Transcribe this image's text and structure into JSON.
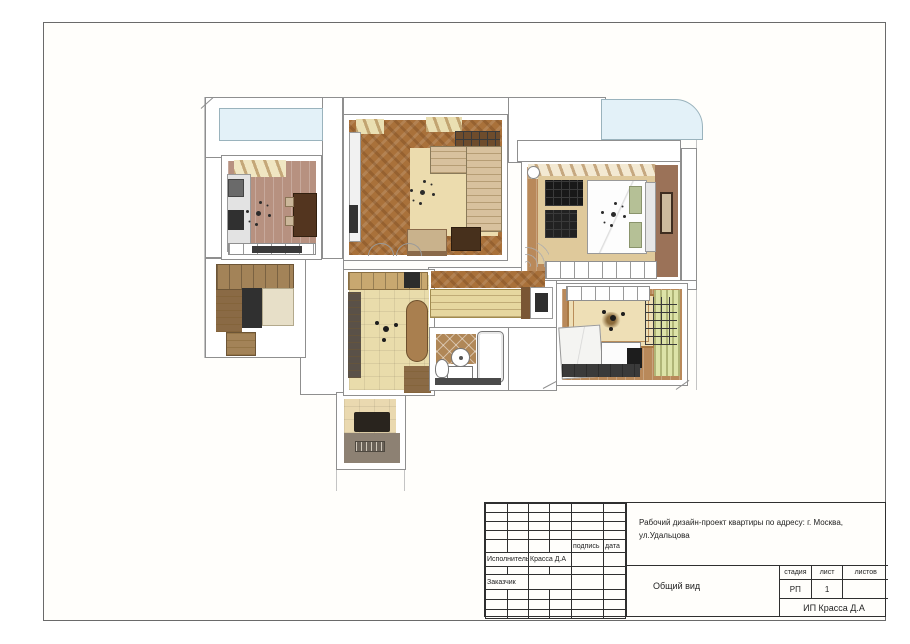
{
  "title_block": {
    "signature_label": "подпись",
    "date_label": "дата",
    "executor_label": "Исполнитель",
    "executor_name": "Красса Д.А",
    "client_label": "Заказчик",
    "project_description": "Рабочий дизайн-проект квартиры по адресу: г. Москва, ул.Удальцова",
    "view_title": "Общий вид",
    "stage_label": "стадия",
    "sheet_label": "лист",
    "sheets_label": "листов",
    "stage_value": "РП",
    "sheet_number": "1",
    "sheets_total": "",
    "company": "ИП Красса Д.А"
  },
  "plan": {
    "glazing_color": "#e3f1f8",
    "rooms": [
      {
        "id": "kitchen",
        "floor_color": "#b79180"
      },
      {
        "id": "living-room",
        "floor_color": "#a9713a",
        "rug_color": "#ecdcae"
      },
      {
        "id": "master-bedroom",
        "floor_color": "#b9895a",
        "rug_color": "#dfc99b",
        "accent_wall_color": "#9b7258"
      },
      {
        "id": "entry-hall",
        "cabinet_color": "#a38358"
      },
      {
        "id": "hallway",
        "floor_color": "#e9dcab"
      },
      {
        "id": "corridor",
        "wardrobe_color": "#e6d79f"
      },
      {
        "id": "bathroom",
        "floor_color": "#b08757"
      },
      {
        "id": "kids-room",
        "floor_color": "#b9895a",
        "rug_color": "#eedfb6",
        "wall_color": "#dde3a8"
      },
      {
        "id": "balcony",
        "floor_color": "#ead9b0"
      }
    ]
  }
}
